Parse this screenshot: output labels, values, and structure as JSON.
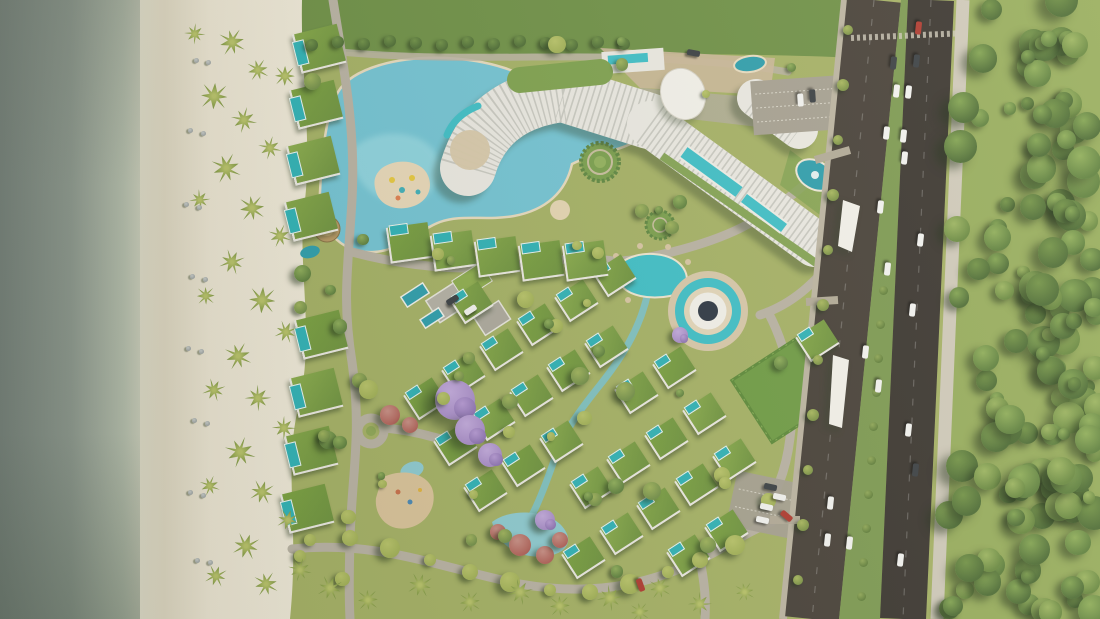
{
  "scene": {
    "title": "resort-master-plan-aerial-rendering",
    "type": "architectural-aerial-render",
    "regions": [
      "ocean",
      "beach",
      "resort-grounds",
      "main-road",
      "forest"
    ]
  },
  "palette": {
    "ocean_deep": "#76817a",
    "ocean_mid": "#8d988e",
    "shallow": "#b3bcab",
    "foam": "#dcd9c6",
    "sand_wet": "#ddd6c1",
    "sand": "#ece5d3",
    "sand2": "#f1ebdb",
    "resort_grass": "#a6b266",
    "lawn_dark": "#6f9147",
    "lawn_bright": "#6f9c45",
    "lagoon": "#74c5d6",
    "lagoon_light": "#9ddde6",
    "pool_bright": "#3fc0c9",
    "pool_dark": "#2e9fae",
    "villa_pool": "#2fb3b8",
    "roof_green": "#84a747",
    "building_white": "#eceae4",
    "building_stripe": "#c2c2ba",
    "canopy_white": "#f4f2ec",
    "plaza_tan": "#ccb89a",
    "deck_tan": "#d9c9ab",
    "road_internal": "#bab3a5",
    "asphalt_1": "#474039",
    "asphalt_2": "#3a3530",
    "sidewalk": "#d0cabb",
    "median_green": "#7d9a52",
    "parking_grey": "#a7a193",
    "forest_base": "#97ad5d",
    "tree_dark": "#4e6d36",
    "tree_mid": "#5f813f",
    "tree_green": "#729347",
    "tree_light": "#82a452",
    "tree_yellow": "#a3b258",
    "purple_tree": "#a88cc9",
    "red_tree": "#b2625a",
    "pink_tree": "#c98f86",
    "sand_play": "#dbc49b",
    "amph_center": "#2e3744",
    "car_white": "#f4f4f2",
    "car_dark": "#3a3f44",
    "car_red": "#b03a30"
  },
  "highway": {
    "carriageway1": {
      "x_top": 874,
      "x_bottom": 812,
      "width": 54
    },
    "carriageway2": {
      "x_top": 931,
      "x_bottom": 903,
      "width": 46
    },
    "sidewalk": {
      "x_top": 963,
      "x_bottom": 937,
      "width": 13
    },
    "median_polygon": [
      [
        901,
        0
      ],
      [
        908,
        0
      ],
      [
        880,
        619
      ],
      [
        839,
        619
      ]
    ]
  },
  "cars": [
    [
      918,
      28,
      "r"
    ],
    [
      893,
      63,
      "d"
    ],
    [
      916,
      61,
      "d"
    ],
    [
      896,
      91,
      "w"
    ],
    [
      908,
      92,
      "w"
    ],
    [
      886,
      133,
      "w"
    ],
    [
      903,
      136,
      "w"
    ],
    [
      904,
      158,
      "w"
    ],
    [
      880,
      207,
      "w"
    ],
    [
      920,
      240,
      "w"
    ],
    [
      887,
      269,
      "w"
    ],
    [
      912,
      310,
      "w"
    ],
    [
      865,
      352,
      "w"
    ],
    [
      878,
      386,
      "w"
    ],
    [
      908,
      430,
      "w"
    ],
    [
      915,
      470,
      "d"
    ],
    [
      830,
      503,
      "w"
    ],
    [
      827,
      540,
      "w"
    ],
    [
      849,
      543,
      "w"
    ],
    [
      900,
      560,
      "w"
    ],
    [
      786,
      516,
      "r",
      40
    ],
    [
      770,
      487,
      "d",
      12
    ],
    [
      779,
      497,
      "w",
      12
    ],
    [
      766,
      507,
      "w",
      12
    ],
    [
      762,
      520,
      "w",
      12
    ],
    [
      640,
      585,
      "r",
      70
    ],
    [
      693,
      53,
      "d",
      10
    ],
    [
      800,
      100,
      "w",
      86
    ],
    [
      812,
      96,
      "d",
      86
    ],
    [
      470,
      310,
      "w",
      -33
    ],
    [
      452,
      300,
      "d",
      -33
    ]
  ],
  "villa_grid": {
    "origin": [
      424,
      398
    ],
    "u": [
      37.8,
      -24.5
    ],
    "v": [
      30,
      46.1
    ],
    "cols": 10,
    "rows": 7,
    "row_start": -1,
    "size": [
      32,
      27
    ],
    "rotation": -33,
    "polygon": [
      [
        398,
        420
      ],
      [
        470,
        298
      ],
      [
        585,
        250
      ],
      [
        700,
        278
      ],
      [
        822,
        342
      ],
      [
        830,
        428
      ],
      [
        733,
        537
      ],
      [
        640,
        580
      ],
      [
        518,
        563
      ],
      [
        430,
        503
      ]
    ],
    "exclusions": [
      [
        520,
        534,
        46
      ],
      [
        412,
        498,
        38
      ],
      [
        610,
        422,
        34
      ],
      [
        708,
        311,
        58
      ],
      [
        788,
        388,
        55
      ],
      [
        371,
        431,
        34
      ],
      [
        648,
        330,
        22
      ],
      [
        600,
        380,
        22
      ],
      [
        556,
        465,
        20
      ],
      [
        652,
        278,
        26
      ]
    ]
  },
  "beach_villas": [
    [
      318,
      48
    ],
    [
      315,
      104
    ],
    [
      312,
      160
    ],
    [
      310,
      216
    ],
    [
      320,
      334
    ],
    [
      315,
      392
    ],
    [
      310,
      450
    ],
    [
      306,
      508
    ]
  ],
  "lagoon_villas": [
    [
      408,
      242
    ],
    [
      452,
      250
    ],
    [
      496,
      256
    ],
    [
      540,
      260
    ],
    [
      584,
      260
    ]
  ],
  "palms": {
    "beach": [
      [
        232,
        42,
        1.1
      ],
      [
        258,
        70,
        0.9
      ],
      [
        214,
        96,
        1.2
      ],
      [
        244,
        120,
        1.0
      ],
      [
        270,
        148,
        0.9
      ],
      [
        226,
        168,
        1.2
      ],
      [
        200,
        200,
        0.8
      ],
      [
        252,
        208,
        1.1
      ],
      [
        280,
        236,
        0.9
      ],
      [
        232,
        262,
        1.0
      ],
      [
        206,
        296,
        0.8
      ],
      [
        262,
        300,
        1.2
      ],
      [
        286,
        332,
        0.9
      ],
      [
        238,
        356,
        1.1
      ],
      [
        214,
        390,
        0.9
      ],
      [
        258,
        398,
        1.0
      ],
      [
        284,
        428,
        0.9
      ],
      [
        240,
        452,
        1.2
      ],
      [
        210,
        486,
        0.8
      ],
      [
        262,
        492,
        1.0
      ],
      [
        288,
        520,
        0.9
      ],
      [
        246,
        546,
        1.1
      ],
      [
        216,
        576,
        0.9
      ],
      [
        266,
        584,
        1.0
      ],
      [
        195,
        34,
        0.8
      ],
      [
        285,
        76,
        0.9
      ]
    ],
    "south": [
      [
        330,
        588,
        1.0
      ],
      [
        368,
        600,
        0.9
      ],
      [
        420,
        585,
        1.0
      ],
      [
        470,
        602,
        0.9
      ],
      [
        520,
        592,
        1.0
      ],
      [
        560,
        606,
        0.9
      ],
      [
        610,
        598,
        1.0
      ],
      [
        660,
        588,
        0.9
      ],
      [
        700,
        604,
        0.9
      ],
      [
        745,
        592,
        0.8
      ],
      [
        300,
        570,
        0.9
      ],
      [
        640,
        612,
        0.8
      ]
    ]
  },
  "beach_furniture": [
    [
      196,
      60
    ],
    [
      208,
      62
    ],
    [
      190,
      130
    ],
    [
      203,
      133
    ],
    [
      186,
      204
    ],
    [
      199,
      207
    ],
    [
      192,
      276
    ],
    [
      205,
      279
    ],
    [
      188,
      348
    ],
    [
      201,
      351
    ],
    [
      194,
      420
    ],
    [
      207,
      423
    ],
    [
      190,
      492
    ],
    [
      203,
      495
    ],
    [
      197,
      560
    ],
    [
      210,
      562
    ]
  ],
  "tree_clusters": {
    "purple": [
      [
        455,
        400,
        20
      ],
      [
        470,
        430,
        15
      ],
      [
        490,
        455,
        12
      ],
      [
        545,
        520,
        10
      ],
      [
        680,
        335,
        8
      ]
    ],
    "red": [
      [
        520,
        545,
        11
      ],
      [
        545,
        555,
        9
      ],
      [
        498,
        532,
        8
      ],
      [
        390,
        415,
        10
      ],
      [
        410,
        425,
        8
      ],
      [
        560,
        540,
        8
      ]
    ],
    "hedge_top": {
      "x0": 312,
      "x1": 648,
      "step": 26,
      "y": 43,
      "r": 7
    },
    "bottom_road": [
      [
        310,
        540
      ],
      [
        350,
        538
      ],
      [
        390,
        548
      ],
      [
        430,
        560
      ],
      [
        470,
        572
      ],
      [
        510,
        582
      ],
      [
        550,
        590
      ],
      [
        590,
        592
      ],
      [
        630,
        584
      ],
      [
        668,
        572
      ],
      [
        700,
        560
      ],
      [
        735,
        545
      ],
      [
        300,
        556
      ]
    ],
    "left_verge": [
      [
        848,
        30
      ],
      [
        843,
        85
      ],
      [
        838,
        140
      ],
      [
        833,
        195
      ],
      [
        828,
        250
      ],
      [
        823,
        305
      ],
      [
        818,
        360
      ],
      [
        813,
        415
      ],
      [
        808,
        470
      ],
      [
        803,
        525
      ],
      [
        798,
        580
      ]
    ],
    "median": {
      "y0": 290,
      "y1": 610,
      "step": 34
    }
  },
  "forest": {
    "count": 170,
    "seed": 7
  },
  "resort_scatter": {
    "count": 70,
    "seed": 11
  }
}
